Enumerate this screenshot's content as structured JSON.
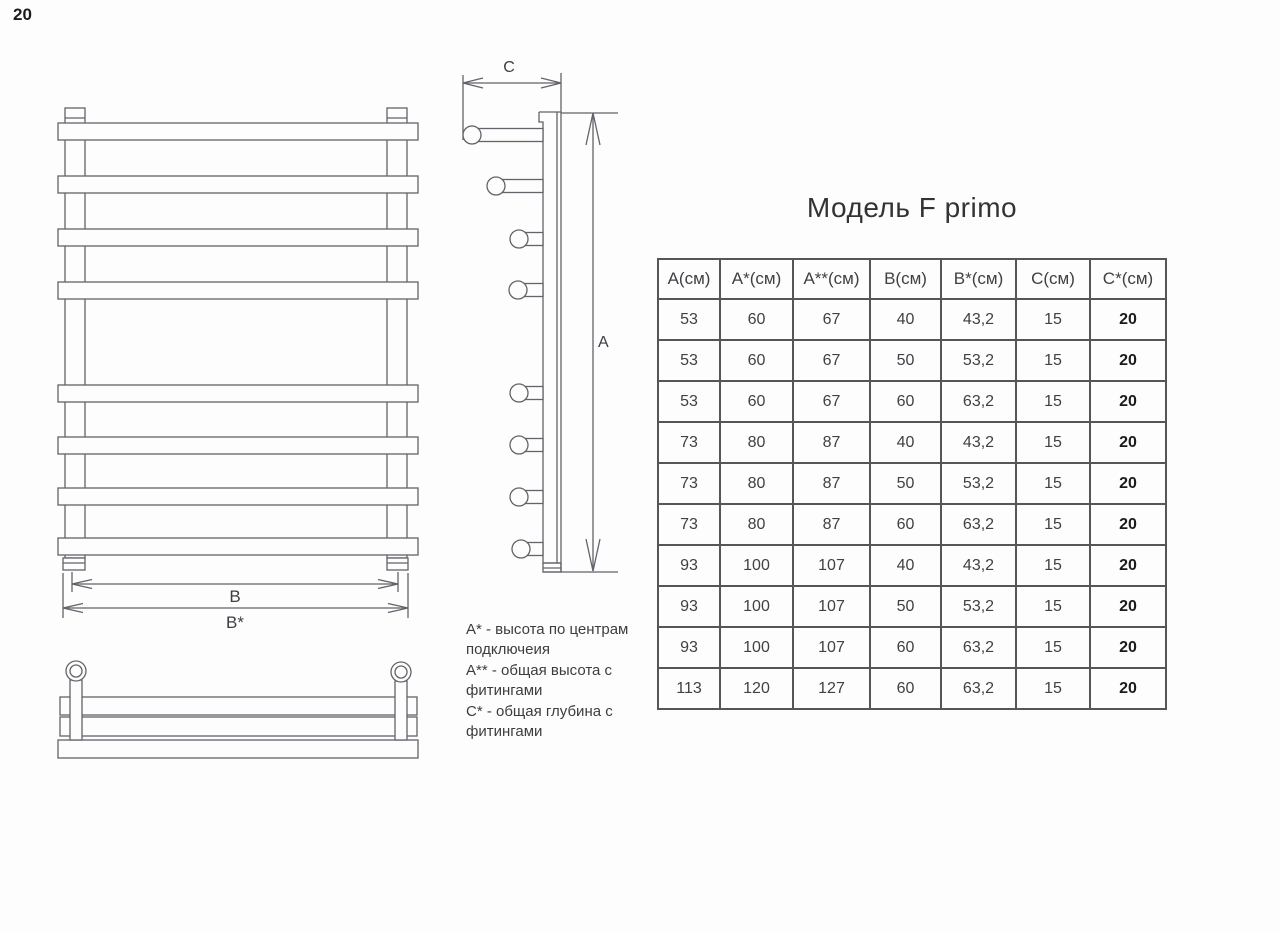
{
  "page": {
    "number": "20"
  },
  "title": "Модель F primo",
  "table": {
    "headers": [
      "А(см)",
      "А*(см)",
      "А**(см)",
      "В(см)",
      "В*(см)",
      "С(см)",
      "С*(см)"
    ],
    "rows": [
      [
        "53",
        "60",
        "67",
        "40",
        "43,2",
        "15",
        "20"
      ],
      [
        "53",
        "60",
        "67",
        "50",
        "53,2",
        "15",
        "20"
      ],
      [
        "53",
        "60",
        "67",
        "60",
        "63,2",
        "15",
        "20"
      ],
      [
        "73",
        "80",
        "87",
        "40",
        "43,2",
        "15",
        "20"
      ],
      [
        "73",
        "80",
        "87",
        "50",
        "53,2",
        "15",
        "20"
      ],
      [
        "73",
        "80",
        "87",
        "60",
        "63,2",
        "15",
        "20"
      ],
      [
        "93",
        "100",
        "107",
        "40",
        "43,2",
        "15",
        "20"
      ],
      [
        "93",
        "100",
        "107",
        "50",
        "53,2",
        "15",
        "20"
      ],
      [
        "93",
        "100",
        "107",
        "60",
        "63,2",
        "15",
        "20"
      ],
      [
        "113",
        "120",
        "127",
        "60",
        "63,2",
        "15",
        "20"
      ]
    ]
  },
  "notes": [
    "А* - высота по центрам подключеия",
    "А** - общая высота с фитингами",
    "С* - общая глубина с фитингами"
  ],
  "dims": {
    "a": "А",
    "b": "В",
    "b_star": "В*",
    "c": "С"
  },
  "colors": {
    "background": "#fdfdfd",
    "line": "#63636a",
    "table_border": "#55555a",
    "text": "#3a3a3a"
  }
}
